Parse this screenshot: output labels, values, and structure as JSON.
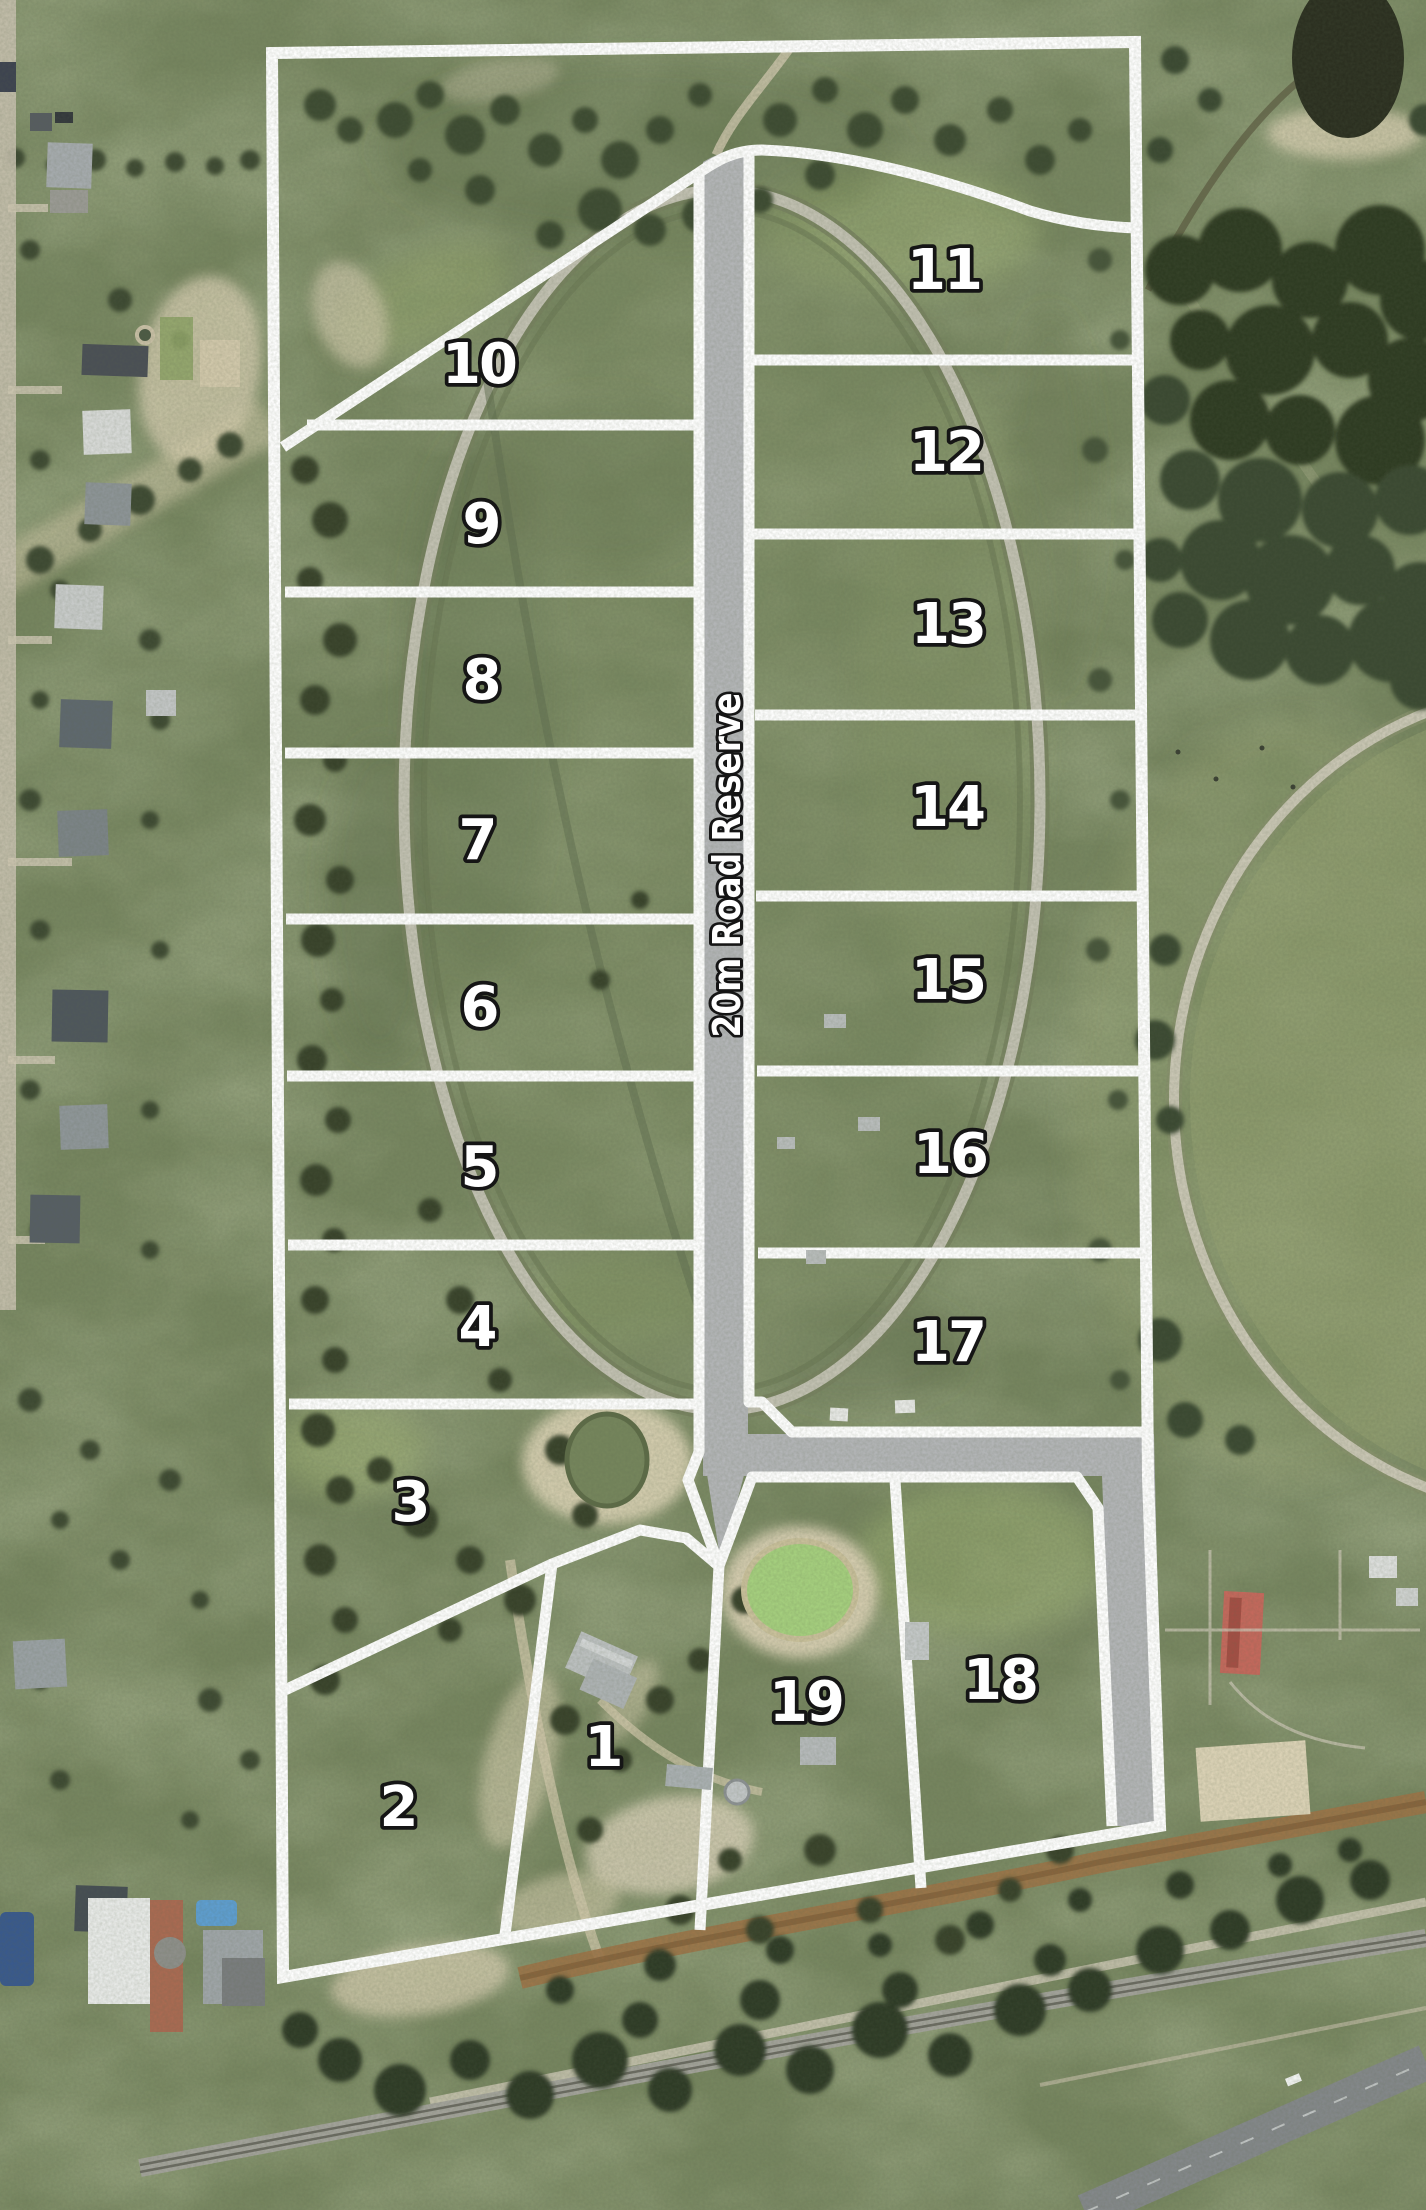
{
  "map": {
    "road_label": "20m Road Reserve",
    "lots": [
      {
        "number": "1",
        "x": 603,
        "y": 1745
      },
      {
        "number": "2",
        "x": 398,
        "y": 1805
      },
      {
        "number": "3",
        "x": 410,
        "y": 1500
      },
      {
        "number": "4",
        "x": 477,
        "y": 1325
      },
      {
        "number": "5",
        "x": 479,
        "y": 1165
      },
      {
        "number": "6",
        "x": 479,
        "y": 1005
      },
      {
        "number": "7",
        "x": 477,
        "y": 838
      },
      {
        "number": "8",
        "x": 481,
        "y": 678
      },
      {
        "number": "9",
        "x": 481,
        "y": 522
      },
      {
        "number": "10",
        "x": 479,
        "y": 362
      },
      {
        "number": "11",
        "x": 944,
        "y": 268
      },
      {
        "number": "12",
        "x": 946,
        "y": 450
      },
      {
        "number": "13",
        "x": 948,
        "y": 622
      },
      {
        "number": "14",
        "x": 947,
        "y": 805
      },
      {
        "number": "15",
        "x": 948,
        "y": 978
      },
      {
        "number": "16",
        "x": 950,
        "y": 1152
      },
      {
        "number": "17",
        "x": 948,
        "y": 1340
      },
      {
        "number": "18",
        "x": 1000,
        "y": 1678
      },
      {
        "number": "19",
        "x": 806,
        "y": 1700
      }
    ],
    "colors": {
      "lot_line": "#ffffff",
      "road_fill": "#b3b5b7",
      "label_fill": "#ffffff",
      "label_outline": "#151515"
    }
  }
}
